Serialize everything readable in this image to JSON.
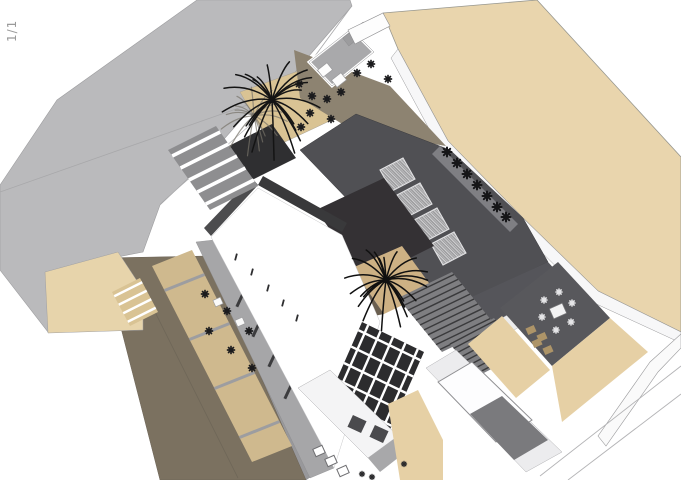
{
  "page": {
    "indicator": "1/1"
  },
  "palette": {
    "background": "#ffffff",
    "road_gray": "#bababc",
    "ground_tan": "#e9d5ad",
    "terrace_brown": "#8d8371",
    "driveway_olive": "#7b7160",
    "roof_dark": "#505054",
    "roof_charcoal": "#343134",
    "roof_white": "#ffffff",
    "tree_dark": "#141414"
  },
  "scene": {
    "width": 681,
    "height": 480,
    "background": "#ffffff",
    "description": "axonometric-site-rendering-of-villa",
    "shapes": [
      {
        "name": "road-surface",
        "kind": "poly",
        "points": "197,0 350,0 352,6 290,78 248,112 195,172 160,205 143,252 60,268 48,332 0,270 0,185 57,100",
        "fill": "#bababc",
        "stroke": "#9d9d9f",
        "sw": 0.6
      },
      {
        "name": "road-crease-1",
        "kind": "line",
        "x1": 0,
        "y1": 192,
        "x2": 290,
        "y2": 90,
        "color": "#a8a8aa",
        "lw": 0.8
      },
      {
        "name": "road-crease-2",
        "kind": "line",
        "x1": 290,
        "y1": 90,
        "x2": 351,
        "y2": 7,
        "color": "#a8a8aa",
        "lw": 0.8
      },
      {
        "name": "road-crease-3",
        "kind": "line",
        "x1": 290,
        "y1": 90,
        "x2": 160,
        "y2": 204,
        "color": "#aeaeb0",
        "lw": 0.6
      },
      {
        "name": "tan-northeast-lot",
        "kind": "poly",
        "points": "383,13 537,0 681,157 681,332 598,291 523,218 448,141 398,49",
        "fill": "#e9d5ad",
        "stroke": "#97978f",
        "sw": 0.8
      },
      {
        "name": "northeast-boundary-wall",
        "kind": "poly",
        "points": "398,49 448,141 523,218 598,291 681,332 681,343 592,302 517,228 441,151 391,58",
        "fill": "#f7f7f8",
        "stroke": "#98989a",
        "sw": 0.5
      },
      {
        "name": "southeast-boundary-wall",
        "kind": "poly",
        "points": "681,334 650,362 598,436 606,446 658,372 681,348",
        "fill": "#fafafa",
        "stroke": "#9a9a9c",
        "sw": 0.6
      },
      {
        "name": "southeast-wall-line-1",
        "kind": "line",
        "x1": 681,
        "y1": 366,
        "x2": 540,
        "y2": 476,
        "color": "#b4b4b6",
        "lw": 0.9
      },
      {
        "name": "southeast-wall-line-2",
        "kind": "line",
        "x1": 681,
        "y1": 394,
        "x2": 568,
        "y2": 480,
        "color": "#b4b4b6",
        "lw": 0.9
      },
      {
        "name": "side-walkway",
        "kind": "poly",
        "points": "208,256 232,246 332,462 306,480",
        "fill": "#98989b",
        "stroke": "#818184",
        "sw": 0.4
      },
      {
        "name": "driveway",
        "kind": "poly",
        "points": "103,258 208,256 306,480 160,480",
        "fill": "#7b7160",
        "stroke": "#6b6255",
        "sw": 0.5
      },
      {
        "name": "driveway-crease",
        "kind": "line",
        "x1": 148,
        "y1": 298,
        "x2": 238,
        "y2": 478,
        "color": "#6e6657",
        "lw": 0.8
      },
      {
        "name": "west-stair-court",
        "kind": "poly",
        "points": "45,272 118,252 143,290 143,330 48,333",
        "fill": "#e7d4ab",
        "stroke": "#a0a0a2",
        "sw": 0.5
      },
      {
        "name": "west-steps",
        "kind": "slats",
        "quad": [
          [
            112,
            292
          ],
          [
            140,
            278
          ],
          [
            158,
            312
          ],
          [
            130,
            326
          ]
        ],
        "fill": "#d9c394",
        "n": 4,
        "color": "#ffffff",
        "lw": 2.4
      },
      {
        "name": "west-terraces",
        "kind": "slats",
        "quad": [
          [
            152,
            266
          ],
          [
            192,
            250
          ],
          [
            292,
            446
          ],
          [
            252,
            462
          ]
        ],
        "fill": "#cfb98e",
        "n": 4,
        "color": "#9d9da0",
        "lw": 3
      },
      {
        "name": "west-facade-band",
        "kind": "poly",
        "points": "196,242 214,240 334,468 310,478",
        "fill": "#a6a6a8",
        "stroke": "#8c8c8e",
        "sw": 0.4
      },
      {
        "name": "west-facade-windows",
        "kind": "rects",
        "w": 3,
        "h": 15,
        "angle": 25,
        "fill": "#3c3c3e",
        "pts": [
          [
            240,
            300
          ],
          [
            256,
            330
          ],
          [
            272,
            360
          ],
          [
            288,
            392
          ]
        ]
      },
      {
        "name": "palm-court-upper",
        "kind": "poly",
        "points": "240,92 301,70 336,118 272,148",
        "fill": "#d9c394",
        "stroke": "#a8a193",
        "sw": 0.5
      },
      {
        "name": "upper-terrace",
        "kind": "poly",
        "points": "294,50 390,86 446,146 352,130 300,98",
        "fill": "#8d8371"
      },
      {
        "name": "entry-court",
        "kind": "poly",
        "points": "309,62 351,29 374,52 332,86",
        "fill": "#a9a9ab",
        "stroke": "#ffffff",
        "sw": 3
      },
      {
        "name": "entry-court-outline",
        "kind": "poly",
        "points": "309,62 351,29 374,52 332,86",
        "fill": "none",
        "stroke": "#8e8e90",
        "sw": 0.5
      },
      {
        "name": "entry-benches",
        "kind": "rects",
        "w": 12,
        "h": 9,
        "angle": -38,
        "fill": "#fdfdfd",
        "stroke": "#9a9a9c",
        "sw": 0.7,
        "pts": [
          [
            325,
            70
          ],
          [
            339,
            80
          ]
        ]
      },
      {
        "name": "entry-stub-wall",
        "kind": "rects",
        "w": 26,
        "h": 10,
        "angle": -38,
        "fill": "#9c9c9e",
        "stroke": "#8e8e90",
        "sw": 0.5,
        "pts": [
          [
            356,
            34
          ]
        ]
      },
      {
        "name": "entry-wall-strip",
        "kind": "poly",
        "points": "348,30 383,13 390,26 355,44",
        "fill": "#fdfdfd",
        "stroke": "#8e8e90",
        "sw": 0.6
      },
      {
        "name": "upper-terrace-chairs",
        "kind": "glyphs",
        "size": 7,
        "lw": 1.7,
        "color": "#1b1b1d",
        "pts": [
          [
            299,
            84
          ],
          [
            312,
            96
          ],
          [
            327,
            99
          ],
          [
            341,
            92
          ],
          [
            357,
            73
          ],
          [
            371,
            64
          ],
          [
            388,
            79
          ],
          [
            310,
            113
          ],
          [
            331,
            119
          ],
          [
            301,
            127
          ]
        ]
      },
      {
        "name": "dark-roof-main",
        "kind": "poly",
        "points": "356,114 450,150 523,218 548,262 452,308 300,150",
        "fill": "#505054",
        "stroke": "#3a3a3d",
        "sw": 0.5
      },
      {
        "name": "roof-edge-shelf",
        "kind": "poly",
        "points": "440,146 518,224 510,232 432,154",
        "fill": "#7f7f83"
      },
      {
        "name": "roof-skylights",
        "kind": "polys",
        "fill": "url(#skl)",
        "stroke": "#e2e2e4",
        "sw": 1.1,
        "items": [
          "380,170 403,158 415,179 392,191",
          "397,195 420,183 432,204 409,216",
          "414,220 437,208 449,229 426,241",
          "431,244 454,232 466,253 443,265"
        ]
      },
      {
        "name": "roof-edge-planters",
        "kind": "glyphs",
        "size": 9,
        "lw": 2,
        "color": "#161618",
        "pts": [
          [
            447,
            152
          ],
          [
            457,
            163
          ],
          [
            467,
            174
          ],
          [
            477,
            185
          ],
          [
            487,
            196
          ],
          [
            497,
            207
          ],
          [
            506,
            217
          ]
        ]
      },
      {
        "name": "charcoal-roof-box",
        "kind": "poly",
        "points": "316,210 384,178 434,246 366,280",
        "fill": "#343134"
      },
      {
        "name": "palm-court-lower",
        "kind": "poly",
        "points": "352,268 402,246 434,290 384,314",
        "fill": "#cdb184"
      },
      {
        "name": "palm-court-lower-shadow",
        "kind": "poly",
        "points": "352,268 338,288 364,318 384,314",
        "fill": "#6a5f50"
      },
      {
        "name": "roof-tail",
        "kind": "poly",
        "points": "452,306 548,262 566,282 470,336",
        "fill": "#55555a"
      },
      {
        "name": "eave-band",
        "kind": "poly",
        "points": "470,336 566,282 578,294 482,348",
        "fill": "#ececed",
        "stroke": "#a2a2a4",
        "sw": 0.4
      },
      {
        "name": "louver-roof-1",
        "kind": "slats",
        "quad": [
          [
            398,
            298
          ],
          [
            452,
            272
          ],
          [
            496,
            326
          ],
          [
            442,
            352
          ]
        ],
        "fill": "#7e7e81",
        "n": 11,
        "color": "#3a3a3c",
        "lw": 1.4
      },
      {
        "name": "louver-roof-2",
        "kind": "slats",
        "quad": [
          [
            448,
            342
          ],
          [
            494,
            318
          ],
          [
            524,
            352
          ],
          [
            478,
            376
          ]
        ],
        "fill": "#7e7e81",
        "n": 8,
        "color": "#3a3a3c",
        "lw": 1.4
      },
      {
        "name": "dining-terrace",
        "kind": "poly",
        "points": "500,308 558,262 610,318 552,366",
        "fill": "#58585c"
      },
      {
        "name": "dining-steps",
        "kind": "rects",
        "w": 9,
        "h": 7,
        "angle": -24,
        "fill": "#ad9468",
        "pts": [
          [
            531,
            330
          ],
          [
            542,
            337
          ],
          [
            537,
            343
          ],
          [
            548,
            350
          ]
        ]
      },
      {
        "name": "dining-table",
        "kind": "rects",
        "w": 14,
        "h": 11,
        "angle": -24,
        "fill": "#f2f2f3",
        "stroke": "#77777a",
        "sw": 0.7,
        "pts": [
          [
            558,
            311
          ]
        ]
      },
      {
        "name": "dining-chairs",
        "kind": "glyphs",
        "size": 6,
        "lw": 1.6,
        "color": "#e6e6e8",
        "pts": [
          [
            544,
            300
          ],
          [
            559,
            292
          ],
          [
            572,
            303
          ],
          [
            571,
            322
          ],
          [
            556,
            330
          ],
          [
            542,
            317
          ]
        ]
      },
      {
        "name": "tan-pocket-south",
        "kind": "poly",
        "points": "468,344 502,316 550,370 516,398",
        "fill": "#e6d0a5"
      },
      {
        "name": "tan-walkway-southeast",
        "kind": "poly",
        "points": "552,366 610,318 648,352 562,422",
        "fill": "#e6d0a5"
      },
      {
        "name": "white-roof",
        "kind": "poly",
        "points": "258,188 342,235 380,322 334,468 211,237",
        "fill": "#ffffff",
        "stroke": "#c8c8ca",
        "sw": 0.5
      },
      {
        "name": "white-roof-parapet-ne",
        "kind": "poly",
        "points": "258,185 342,232 347,223 263,176",
        "fill": "#39393b"
      },
      {
        "name": "white-roof-parapet-nw",
        "kind": "poly",
        "points": "204,228 252,178 258,185 211,236",
        "fill": "#4c4c4e"
      },
      {
        "name": "stair-landing",
        "kind": "poly",
        "points": "225,148 272,124 296,158 248,182",
        "fill": "#2f2f31"
      },
      {
        "name": "roof-stairs",
        "kind": "slats",
        "quad": [
          [
            168,
            150
          ],
          [
            216,
            126
          ],
          [
            258,
            186
          ],
          [
            210,
            210
          ]
        ],
        "fill": "#8e8e90",
        "n": 5,
        "color": "#ffffff",
        "lw": 3.6
      },
      {
        "name": "pergola-base",
        "kind": "poly",
        "points": "362,322 424,352 388,434 326,404",
        "fill": "#2c2c2e"
      },
      {
        "name": "pergola-beams-a",
        "kind": "slats",
        "quad": [
          [
            362,
            322
          ],
          [
            424,
            352
          ],
          [
            388,
            434
          ],
          [
            326,
            404
          ]
        ],
        "n": 5,
        "color": "#ffffff",
        "lw": 2.4
      },
      {
        "name": "pergola-beams-b",
        "kind": "slats",
        "quad": [
          [
            424,
            352
          ],
          [
            388,
            434
          ],
          [
            326,
            404
          ],
          [
            362,
            322
          ]
        ],
        "n": 5,
        "color": "#ffffff",
        "lw": 2.4
      },
      {
        "name": "southwest-facade",
        "kind": "poly",
        "points": "298,388 330,370 398,436 368,458",
        "fill": "#f4f4f5",
        "stroke": "#9c9c9e",
        "sw": 0.4
      },
      {
        "name": "southwest-facade-panels",
        "kind": "rects",
        "w": 15,
        "h": 13,
        "angle": 25,
        "fill": "#4a4a4d",
        "pts": [
          [
            357,
            424
          ],
          [
            379,
            434
          ]
        ]
      },
      {
        "name": "facade-base-band",
        "kind": "poly",
        "points": "368,458 398,436 408,450 380,472",
        "fill": "#a8a8aa"
      },
      {
        "name": "roof-vent-boxes",
        "kind": "rects",
        "w": 10,
        "h": 8,
        "angle": -24,
        "fill": "#ffffff",
        "stroke": "#6f6f72",
        "sw": 1,
        "pts": [
          [
            319,
            451
          ],
          [
            331,
            461
          ],
          [
            343,
            471
          ]
        ]
      },
      {
        "name": "tan-court-bottom",
        "kind": "poly",
        "points": "388,404 418,390 443,440 443,480 400,480",
        "fill": "#e6d0a5"
      },
      {
        "name": "pool-deck",
        "kind": "poly",
        "points": "426,368 456,350 562,452 526,472",
        "fill": "#ececee",
        "stroke": "#a0a0a2",
        "sw": 0.4
      },
      {
        "name": "pool",
        "kind": "poly",
        "points": "438,382 472,362 532,420 496,442",
        "fill": "#fdfdfe",
        "stroke": "#8f8f92",
        "sw": 1
      },
      {
        "name": "patio-gray",
        "kind": "poly",
        "points": "470,414 502,396 548,440 514,460",
        "fill": "#7a7a7d"
      },
      {
        "name": "bottom-plants",
        "kind": "glyphs",
        "size": 5,
        "lw": 1.4,
        "color": "#2a2a2c",
        "pts": [
          [
            362,
            474
          ],
          [
            372,
            477
          ],
          [
            404,
            464
          ]
        ]
      },
      {
        "name": "west-terrace-chairs",
        "kind": "glyphs",
        "size": 7,
        "lw": 1.7,
        "color": "#1b1b1d",
        "pts": [
          [
            205,
            294
          ],
          [
            227,
            311
          ],
          [
            249,
            331
          ],
          [
            209,
            331
          ],
          [
            231,
            350
          ],
          [
            252,
            368
          ]
        ]
      },
      {
        "name": "west-terrace-tables",
        "kind": "rects",
        "w": 8,
        "h": 7,
        "angle": -24,
        "fill": "#fafafa",
        "stroke": "#9a9a9c",
        "sw": 0.6,
        "pts": [
          [
            218,
            302
          ],
          [
            240,
            322
          ]
        ]
      },
      {
        "name": "fence-posts",
        "kind": "rects",
        "w": 1.8,
        "h": 7,
        "angle": 15,
        "fill": "#2e2e30",
        "pts": [
          [
            236,
            257
          ],
          [
            252,
            272
          ],
          [
            268,
            288
          ],
          [
            283,
            303
          ],
          [
            297,
            318
          ]
        ]
      },
      {
        "name": "palm-tree-upper-shadow",
        "kind": "palm",
        "cx": 254,
        "cy": 116,
        "r": 36,
        "n": 16,
        "color": "#77746a",
        "lw": 1.2,
        "op": 0.7
      },
      {
        "name": "palm-tree-upper",
        "kind": "palm",
        "cx": 272,
        "cy": 100,
        "r": 52,
        "n": 24,
        "color": "#141414",
        "lw": 1.5,
        "op": 1
      },
      {
        "name": "palm-tree-courtyard",
        "kind": "palm",
        "cx": 386,
        "cy": 280,
        "r": 44,
        "n": 22,
        "color": "#101010",
        "lw": 1.5,
        "op": 1
      }
    ]
  }
}
